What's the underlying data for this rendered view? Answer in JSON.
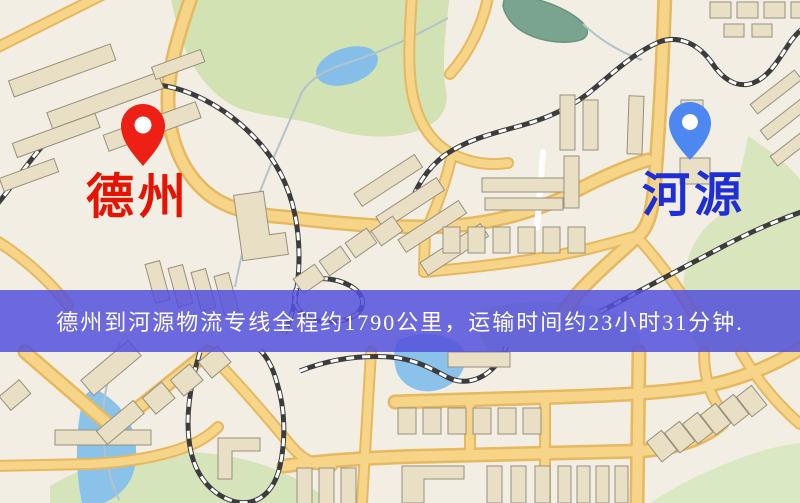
{
  "banner": {
    "text": "德州到河源物流专线全程约1790公里，运输时间约23小时31分钟.",
    "bg_color": "#5350DC",
    "text_color": "#FFFFFF"
  },
  "route": {
    "origin_city": "德州",
    "destination_city": "河源",
    "distance_text": "约1790公里",
    "duration_text": "约23小时31分钟"
  },
  "origin": {
    "name": "德州",
    "label_color": "#E51300",
    "pin_color": "#EE1F14",
    "pin_icon": "map-pin-icon"
  },
  "destination": {
    "name": "河源",
    "label_color": "#1E2FD6",
    "pin_color": "#4D87F2",
    "pin_icon": "map-pin-icon"
  },
  "map": {
    "palette": {
      "background": "#F3EEE4",
      "road_fill": "#F6D488",
      "road_casing": "#E6B85F",
      "building": "#E9DFC4",
      "park_green": "#D2E2B2",
      "water_blue": "#8AC2EA",
      "railway": "#3C3C3C"
    }
  }
}
